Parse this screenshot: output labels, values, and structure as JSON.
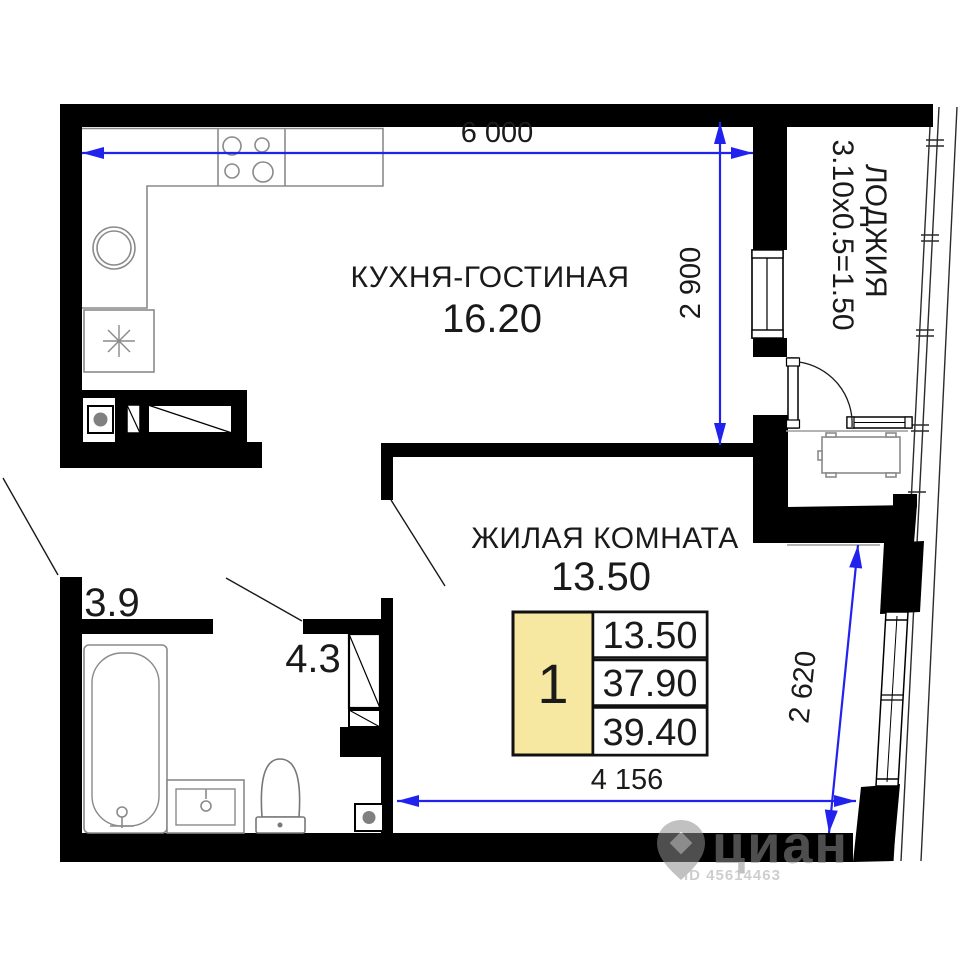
{
  "title": "Floor plan of 1-room apartment",
  "rooms": {
    "kitchen_living": {
      "name": "КУХНЯ-ГОСТИНАЯ",
      "area": "16.20"
    },
    "living": {
      "name": "ЖИЛАЯ КОМНАТА",
      "area": "13.50"
    },
    "bathroom": {
      "area": "3.9"
    },
    "hallway": {
      "area": "4.3"
    },
    "loggia": {
      "name": "ЛОДЖИЯ",
      "size_formula": "3.10х0.5=1.50"
    }
  },
  "dimensions": {
    "top_width": "6 000",
    "kitchen_depth": "2 900",
    "room_width": "4 156",
    "room_depth": "2 620"
  },
  "stamp": {
    "rooms_count": "1",
    "living_area": "13.50",
    "area_without_loggia": "37.90",
    "total_area": "39.40"
  },
  "watermark": {
    "brand": "циан",
    "id_line": "ID 45614463"
  },
  "colors": {
    "wall_black": "#000000",
    "dimension_blue": "#2222ee",
    "furniture_gray": "#8a8a8a",
    "stamp_yellow": "#f6e8a0",
    "text_black": "#1a1a1a",
    "watermark_gray": "#8f8f8f"
  }
}
